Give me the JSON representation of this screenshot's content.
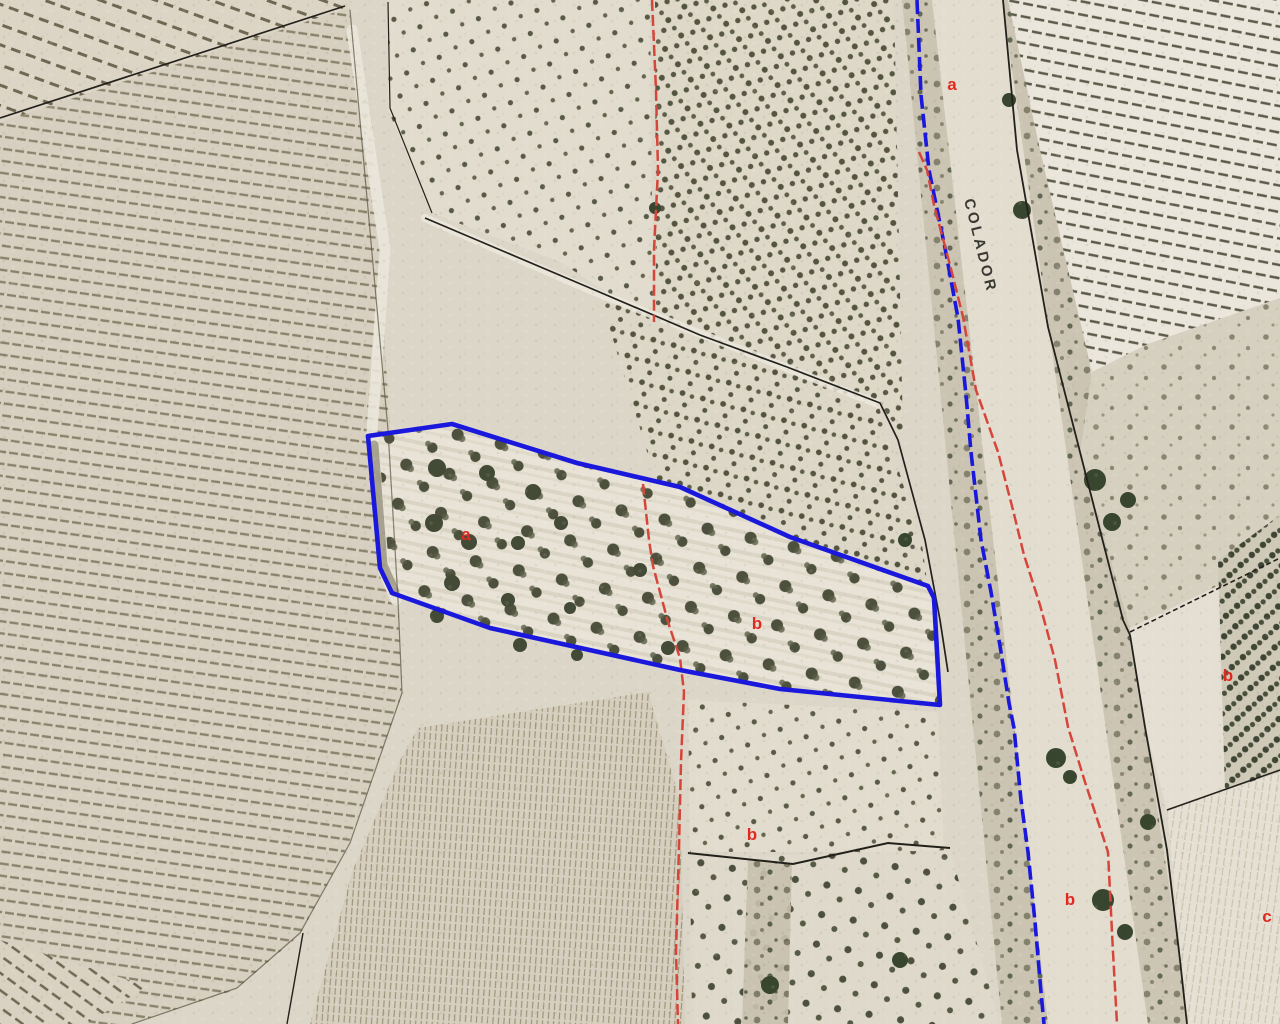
{
  "map": {
    "road_label": {
      "text": "COLADOR",
      "x": 964,
      "y": 200,
      "rotation_deg": 76
    },
    "labels": [
      {
        "text": "a",
        "x": 952,
        "y": 90
      },
      {
        "text": "a",
        "x": 466,
        "y": 540
      },
      {
        "text": "b",
        "x": 757,
        "y": 629
      },
      {
        "text": "b",
        "x": 752,
        "y": 840
      },
      {
        "text": "b",
        "x": 1228,
        "y": 681
      },
      {
        "text": "b",
        "x": 1070,
        "y": 905
      },
      {
        "text": "c",
        "x": 1267,
        "y": 922
      }
    ],
    "colors": {
      "parcel_outline": "#1a18dc",
      "boundary_blue": "#1a18dc",
      "red_line": "#d6453a",
      "label_red": "#e02a20",
      "boundary_black": "#23211c",
      "road_text": "#1d1c18"
    },
    "overlays": {
      "parcel_outline_points": "368,436 452,424 577,463 680,487 790,537 928,586 934,598 940,705 780,689 680,670 490,628 392,593 380,568",
      "boundary_blue_points": "917,0 921,95 929,170 945,248 958,318 966,395 971,452 981,540 991,592 1001,652 1009,703 1014,728 1021,800 1028,852 1035,922 1041,992 1044,1024",
      "red_lines": [
        {
          "name": "red-line-left-upper",
          "points": "652,0 656,90 658,170 654,250 654,322"
        },
        {
          "name": "red-line-left-lower",
          "points": "643,484 649,540 653,566 668,622 680,658 684,692 681,762 679,846 676,952 678,1024"
        },
        {
          "name": "red-line-road",
          "points": "919,152 927,170 934,205 950,265 963,317 976,390 998,452 1013,510 1024,555 1040,605 1055,660 1068,727 1085,782 1108,852 1113,952 1117,1024"
        }
      ],
      "black_boundaries": [
        {
          "name": "boundary-topleft",
          "points": "345,6 0,118",
          "width": 1.7,
          "dash": ""
        },
        {
          "name": "boundary-diagonal",
          "points": "425,218 590,288 700,335 787,367 880,403 898,440 925,540 940,620 948,672",
          "width": 1.7,
          "dash": ""
        },
        {
          "name": "boundary-road-right",
          "points": "1003,0 1017,150 1048,327 1080,452 1123,620 1130,635 1145,727 1167,850 1180,960 1187,1024",
          "width": 1.8,
          "dash": ""
        },
        {
          "name": "boundary-branch-upper",
          "points": "1130,632 1280,558",
          "width": 1.6,
          "dash": "5 3"
        },
        {
          "name": "boundary-branch-lower",
          "points": "1167,810 1280,770",
          "width": 1.6,
          "dash": ""
        },
        {
          "name": "boundary-orchard-left",
          "points": "388,2 390,108 432,213",
          "width": 1.2,
          "dash": ""
        },
        {
          "name": "boundary-hedge",
          "points": "688,853 793,864 888,843 950,848",
          "width": 2,
          "dash": ""
        },
        {
          "name": "boundary-bottomleft",
          "points": "303,933 287,1024",
          "width": 1.4,
          "dash": ""
        }
      ]
    }
  }
}
